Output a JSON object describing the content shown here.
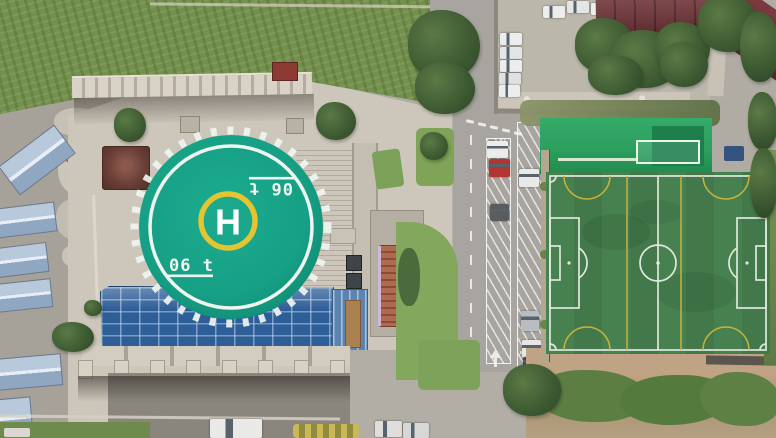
{
  "scene": {
    "type": "aerial-drone-photo",
    "description": "Overhead drone view of a building with a rooftop helipad and blue glass atrium, a stone plaza, an access road with angled parking bays and cars, a green artificial-turf soccer field, a concrete parking lot with white cars, maroon roofed buildings, blue-roofed sheds and an overgrown grass lot",
    "helipad": {
      "letter": "H",
      "weight_marking": "06 t",
      "marking_shown_twice_opposite_orientation": true,
      "surface_color": "#16a085",
      "perimeter_ring_color": "#eef4ee",
      "h_ring_color": "#e4c430"
    },
    "soccer_field": {
      "turf_color": "#47814f",
      "main_line_color": "#dfe8de",
      "mini_pitch_line_color": "#c9b23c",
      "markings": [
        "perimeter",
        "halfway line",
        "center circle",
        "penalty areas",
        "goal areas",
        "penalty arcs",
        "corner arcs",
        "two yellow cross-pitch lines",
        "four yellow semicircle arcs"
      ]
    },
    "areas": {
      "grass_lot": "overgrown grass lot",
      "plaza": "paved plaza with balustrade, pavilion and planters",
      "glass_roof": "blue glass grid atrium roof",
      "stairs": "terraced stairs beside helipad",
      "road": "road with two columns of angled parking bays",
      "parking_lot": "concrete parking lot with cars",
      "sheds": "blue-roofed sheds",
      "dirt": "bare dirt strip with green shrubs"
    },
    "vehicles": {
      "road_bay_cars": [
        "white",
        "red",
        "dark gray",
        "white",
        "silver",
        "white",
        "dark"
      ],
      "parking_lot_cars": "white cars along wall, top edge and under trees",
      "bottom_edge_vehicles": [
        "white van",
        "white car",
        "white car"
      ]
    },
    "colors": {
      "glass_roof_blue": "#2e5e97",
      "shed_roof_blue": "#a9bcd3",
      "wild_grass_green": "#74904e",
      "plaza_paving": "#cdc7bb",
      "road_gray": "#a8a5a0",
      "maroon_roof": "#6d3236",
      "green_rooftop": "#2da05f",
      "tree_canopy": "#3f5c33",
      "dirt_brown": "#a9936f",
      "shrub_green": "#5d7e43"
    }
  }
}
